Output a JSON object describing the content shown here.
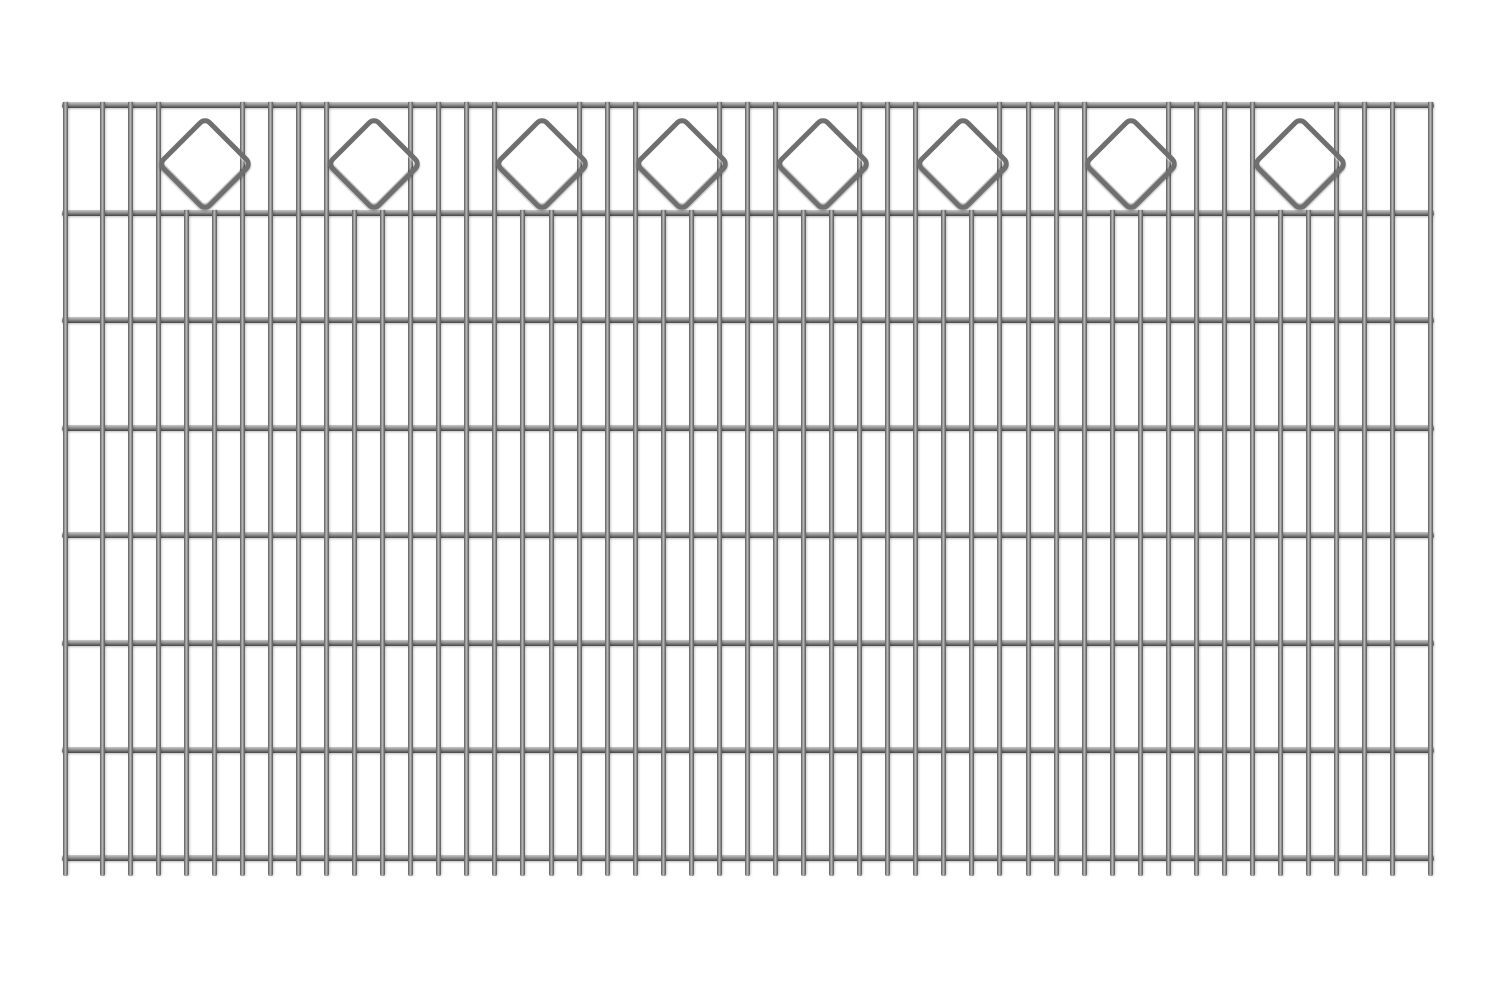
{
  "image": {
    "width": 1500,
    "height": 1000,
    "background_color": "#ffffff"
  },
  "fence_panel": {
    "kind": "double-rod-mesh-fence-panel-with-diamond-ornaments",
    "colors": {
      "wire_dark": "#555555",
      "wire_mid": "#8f8f8f",
      "wire_highlight": "#c4c4c4",
      "rail_dark": "#454545",
      "rail_highlight": "#c9c9c9",
      "ornament_stroke": "#6f6f6f"
    },
    "rails": {
      "x_start": 62,
      "x_end": 1434,
      "thickness": 6,
      "y_centers": [
        105,
        213,
        320,
        428,
        535,
        643,
        750,
        858
      ]
    },
    "vertical_wires": {
      "thickness": 5,
      "full_top_y": 102,
      "short_top_y": 210,
      "bottom_y": 876,
      "items": [
        {
          "x": 65.0,
          "full": true
        },
        {
          "x": 102.0,
          "full": true
        },
        {
          "x": 130.1,
          "full": true
        },
        {
          "x": 158.1,
          "full": true
        },
        {
          "x": 186.2,
          "full": false
        },
        {
          "x": 214.2,
          "full": false
        },
        {
          "x": 242.3,
          "full": true
        },
        {
          "x": 270.4,
          "full": true
        },
        {
          "x": 298.4,
          "full": true
        },
        {
          "x": 326.5,
          "full": true
        },
        {
          "x": 354.5,
          "full": false
        },
        {
          "x": 382.6,
          "full": false
        },
        {
          "x": 410.7,
          "full": true
        },
        {
          "x": 438.7,
          "full": true
        },
        {
          "x": 466.8,
          "full": true
        },
        {
          "x": 494.8,
          "full": true
        },
        {
          "x": 522.9,
          "full": false
        },
        {
          "x": 551.0,
          "full": false
        },
        {
          "x": 579.0,
          "full": true
        },
        {
          "x": 607.1,
          "full": true
        },
        {
          "x": 635.1,
          "full": true
        },
        {
          "x": 663.2,
          "full": false
        },
        {
          "x": 691.3,
          "full": false
        },
        {
          "x": 719.3,
          "full": true
        },
        {
          "x": 747.4,
          "full": true
        },
        {
          "x": 775.4,
          "full": true
        },
        {
          "x": 803.5,
          "full": false
        },
        {
          "x": 831.6,
          "full": false
        },
        {
          "x": 859.6,
          "full": true
        },
        {
          "x": 887.7,
          "full": true
        },
        {
          "x": 915.7,
          "full": true
        },
        {
          "x": 943.8,
          "full": false
        },
        {
          "x": 971.9,
          "full": false
        },
        {
          "x": 999.9,
          "full": true
        },
        {
          "x": 1028.0,
          "full": true
        },
        {
          "x": 1056.0,
          "full": true
        },
        {
          "x": 1084.1,
          "full": true
        },
        {
          "x": 1112.2,
          "full": false
        },
        {
          "x": 1140.2,
          "full": false
        },
        {
          "x": 1168.3,
          "full": true
        },
        {
          "x": 1196.3,
          "full": true
        },
        {
          "x": 1224.4,
          "full": true
        },
        {
          "x": 1252.5,
          "full": true
        },
        {
          "x": 1280.5,
          "full": false
        },
        {
          "x": 1308.6,
          "full": false
        },
        {
          "x": 1336.6,
          "full": true
        },
        {
          "x": 1364.7,
          "full": true
        },
        {
          "x": 1392.8,
          "full": true
        },
        {
          "x": 1430.8,
          "full": true
        }
      ]
    },
    "ornaments": {
      "shape": "rounded-diamond",
      "count": 8,
      "center_y": 159,
      "square_side": 60,
      "corner_radius": 9,
      "stroke_width": 5,
      "centers_x": [
        200.2,
        368.6,
        536.9,
        677.2,
        817.5,
        957.8,
        1126.2,
        1294.6
      ]
    }
  }
}
